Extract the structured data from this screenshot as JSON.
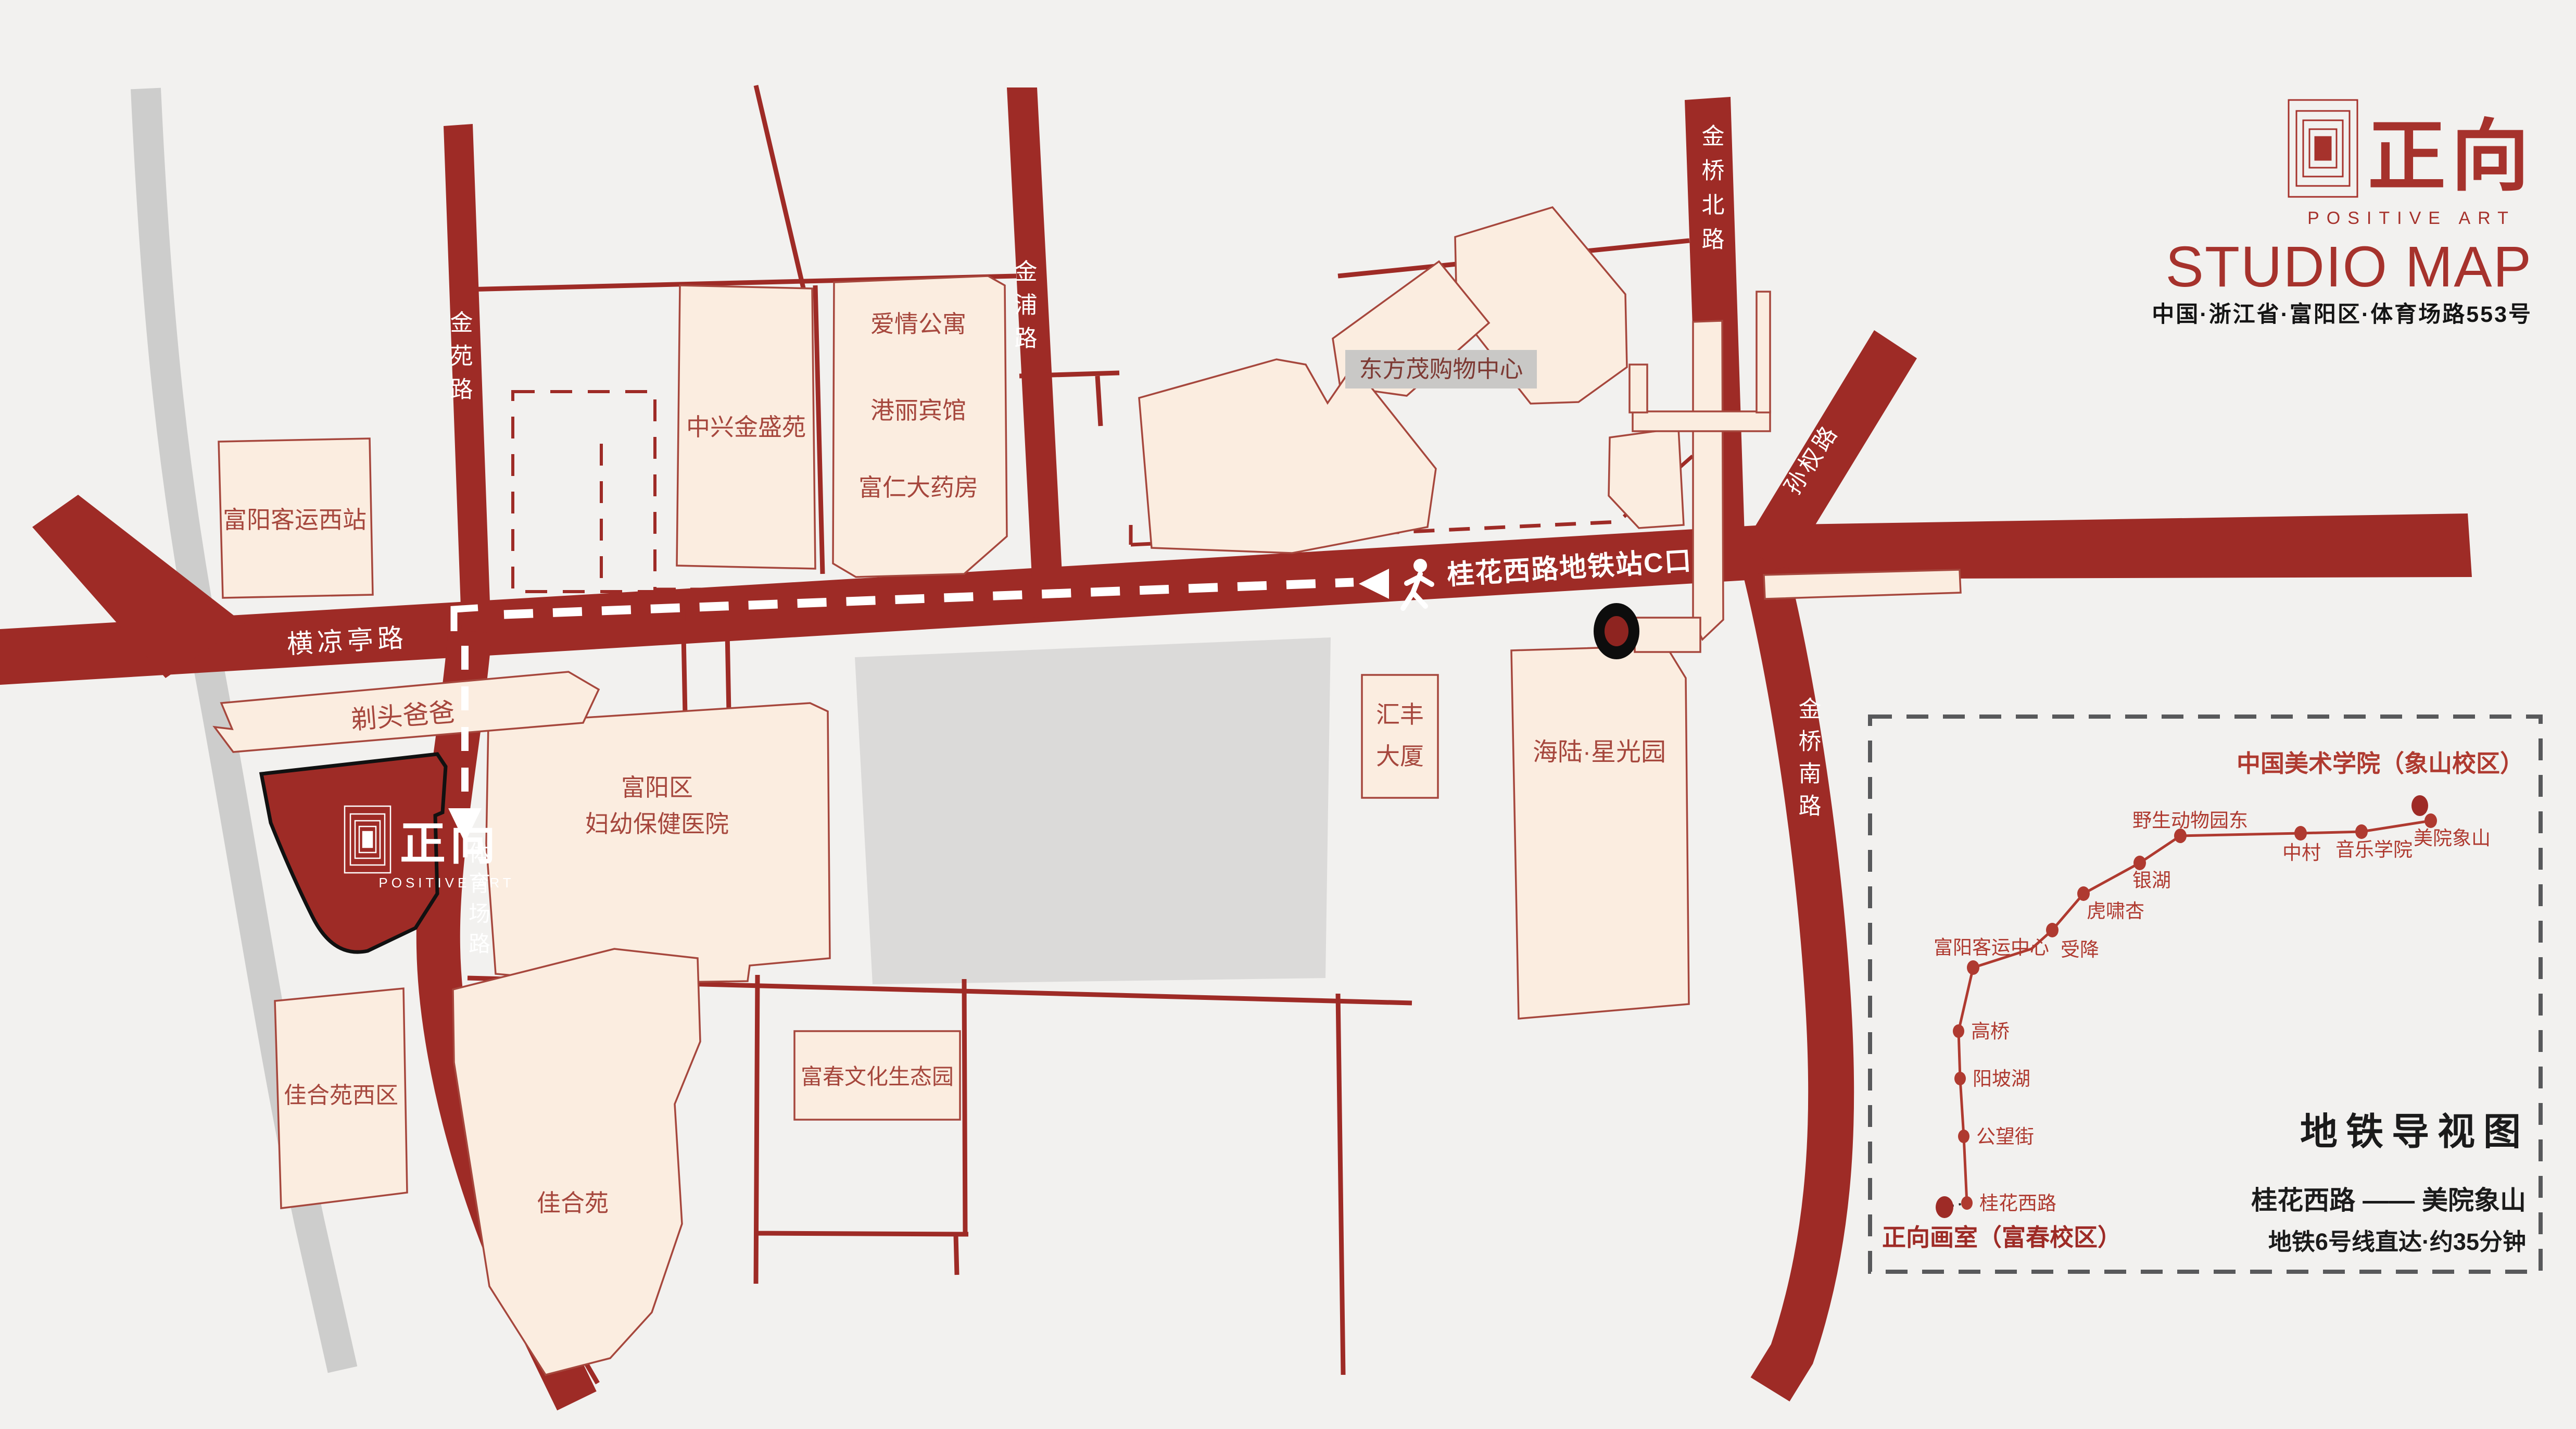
{
  "header": {
    "logo_cn": "正向",
    "logo_en": "POSITIVE ART",
    "title": "STUDIO MAP",
    "address": "中国·浙江省·富阳区·体育场路553号"
  },
  "map": {
    "roads": {
      "jinyuan": "金苑路",
      "jinpu": "金浦路",
      "jinqiao_north": "金桥北路",
      "sunquan": "孙权路",
      "jinqiao_south": "金桥南路",
      "henliangting": "横凉亭路",
      "tiyuchang": "体育场路",
      "metro_exit": "桂花西路地铁站C口"
    },
    "places": {
      "fuyang_west_bus": "富阳客运西站",
      "zhongxing": "中兴金盛苑",
      "aiqing": "爱情公寓",
      "gangli": "港丽宾馆",
      "furen": "富仁大药房",
      "dongfangmao": "东方茂购物中心",
      "huifeng_1": "汇丰",
      "huifeng_2": "大厦",
      "hailu": "海陆·星光园",
      "hospital_1": "富阳区",
      "hospital_2": "妇幼保健医院",
      "titou": "剃头爸爸",
      "jiahe_west": "佳合苑西区",
      "jiahe": "佳合苑",
      "fuchun_park": "富春文化生态园"
    },
    "studio": {
      "cn": "正向",
      "en": "POSITIVE ART"
    }
  },
  "metro_panel": {
    "title": "地铁导视图",
    "route": "桂花西路 —— 美院象山",
    "note": "地铁6号线直达·约35分钟",
    "start": "正向画室（富春校区）",
    "end": "中国美术学院（象山校区）",
    "stations": [
      "桂花西路",
      "公望街",
      "阳坡湖",
      "高桥",
      "富阳客运中心",
      "受降",
      "虎啸杏",
      "银湖",
      "野生动物园东",
      "中村",
      "音乐学院",
      "美院象山"
    ]
  }
}
